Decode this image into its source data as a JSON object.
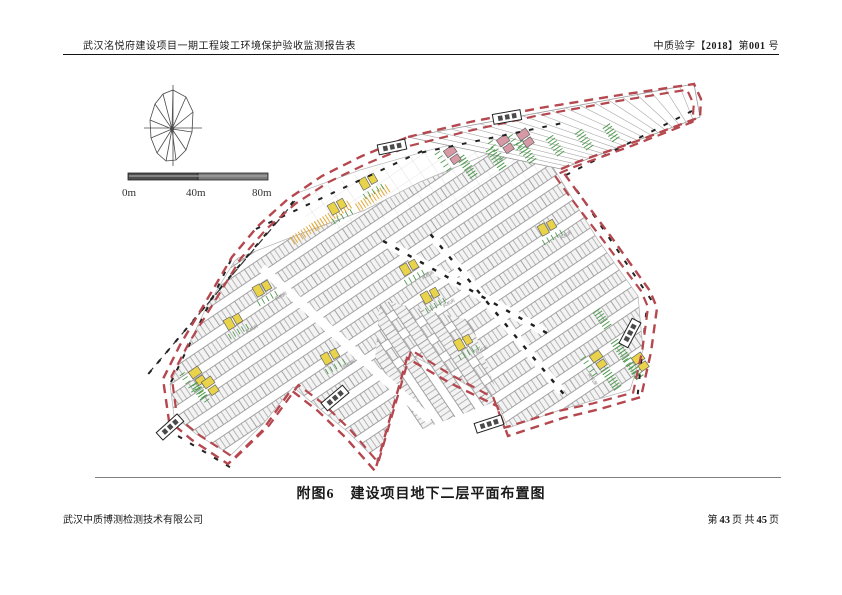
{
  "header": {
    "left": "武汉洺悦府建设项目一期工程竣工环境保护验收监测报告表",
    "right_prefix": "中质验字【",
    "right_year": "2018",
    "right_mid": "】第",
    "right_num": "001",
    "right_suffix": "号"
  },
  "caption": {
    "label": "附图6",
    "title": "建设项目地下二层平面布置图"
  },
  "footer": {
    "company": "武汉中质博测检测技术有限公司",
    "page_prefix": "第",
    "page_current": "43",
    "page_mid": "页 共",
    "page_total": "45",
    "page_suffix": "页"
  },
  "scale_bar": {
    "labels": [
      "0m",
      "40m",
      "80m"
    ]
  },
  "plan": {
    "room_label": "风机房",
    "colors": {
      "boundary": "#b5474f",
      "stall": "#8f8f8f",
      "green": "#4f9b4f",
      "yellow": "#e9d34b",
      "orange": "#e2aa3a",
      "pink": "#d79aa5",
      "black": "#1f1f1f"
    },
    "boundary_outer": [
      [
        408,
        137
      ],
      [
        470,
        122
      ],
      [
        540,
        108
      ],
      [
        620,
        95
      ],
      [
        694,
        84
      ],
      [
        701,
        99
      ],
      [
        700,
        117
      ],
      [
        640,
        140
      ],
      [
        580,
        161
      ],
      [
        561,
        169
      ],
      [
        576,
        190
      ],
      [
        612,
        238
      ],
      [
        650,
        291
      ],
      [
        657,
        308
      ],
      [
        651,
        352
      ],
      [
        641,
        397
      ],
      [
        600,
        409
      ],
      [
        563,
        418
      ],
      [
        508,
        436
      ],
      [
        497,
        406
      ],
      [
        450,
        383
      ],
      [
        407,
        358
      ],
      [
        375,
        471
      ],
      [
        346,
        438
      ],
      [
        318,
        411
      ],
      [
        291,
        390
      ],
      [
        262,
        431
      ],
      [
        228,
        464
      ],
      [
        192,
        440
      ],
      [
        169,
        421
      ],
      [
        163,
        379
      ],
      [
        180,
        345
      ],
      [
        205,
        303
      ],
      [
        232,
        257
      ],
      [
        258,
        226
      ],
      [
        288,
        199
      ],
      [
        322,
        176
      ],
      [
        362,
        156
      ]
    ],
    "grid_band": [
      [
        300,
        195
      ],
      [
        420,
        152
      ],
      [
        560,
        122
      ],
      [
        565,
        168
      ],
      [
        430,
        210
      ],
      [
        310,
        235
      ]
    ],
    "texture_main": [
      [
        238,
        258
      ],
      [
        305,
        232
      ],
      [
        365,
        210
      ],
      [
        420,
        182
      ],
      [
        478,
        158
      ],
      [
        532,
        134
      ],
      [
        556,
        172
      ],
      [
        598,
        240
      ],
      [
        638,
        296
      ],
      [
        643,
        350
      ],
      [
        630,
        390
      ],
      [
        560,
        410
      ],
      [
        508,
        428
      ],
      [
        498,
        404
      ],
      [
        452,
        376
      ],
      [
        409,
        354
      ],
      [
        378,
        462
      ],
      [
        348,
        432
      ],
      [
        293,
        387
      ],
      [
        263,
        424
      ],
      [
        231,
        455
      ],
      [
        196,
        434
      ],
      [
        174,
        416
      ],
      [
        170,
        384
      ],
      [
        206,
        308
      ],
      [
        234,
        262
      ]
    ],
    "texture_alt": [
      [
        380,
        300
      ],
      [
        470,
        320
      ],
      [
        500,
        400
      ],
      [
        420,
        430
      ],
      [
        375,
        360
      ]
    ],
    "strip": {
      "top": [
        [
          408,
          137
        ],
        [
          694,
          84
        ]
      ],
      "bottom": [
        [
          561,
          169
        ],
        [
          700,
          117
        ]
      ],
      "n": 20
    },
    "outline_curve": [
      [
        300,
        192
      ],
      [
        360,
        170
      ],
      [
        430,
        150
      ],
      [
        500,
        133
      ],
      [
        558,
        120
      ]
    ],
    "aisles": [
      {
        "a": [
          432,
          236
        ],
        "b": [
          562,
          392
        ]
      },
      {
        "a": [
          385,
          242
        ],
        "b": [
          545,
          332
        ]
      },
      {
        "a": [
          262,
          268
        ],
        "b": [
          430,
          420
        ]
      }
    ],
    "road_line": {
      "a": [
        148,
        374
      ],
      "b": [
        295,
        201
      ]
    },
    "tick_segments": [
      {
        "a": [
          150,
          372
        ],
        "b": [
          292,
          203
        ]
      },
      {
        "a": [
          258,
          228
        ],
        "b": [
          420,
          152
        ]
      },
      {
        "a": [
          568,
          174
        ],
        "b": [
          690,
          112
        ]
      },
      {
        "a": [
          578,
          192
        ],
        "b": [
          650,
          298
        ]
      },
      {
        "a": [
          646,
          315
        ],
        "b": [
          638,
          392
        ]
      },
      {
        "a": [
          172,
          380
        ],
        "b": [
          230,
          262
        ]
      },
      {
        "a": [
          424,
          152
        ],
        "b": [
          558,
          124
        ]
      },
      {
        "a": [
          168,
          430
        ],
        "b": [
          228,
          466
        ]
      }
    ],
    "green_clusters": [
      [
        468,
        168,
        55,
        8
      ],
      [
        497,
        160,
        55,
        8
      ],
      [
        527,
        153,
        55,
        8
      ],
      [
        556,
        147,
        55,
        7
      ],
      [
        585,
        141,
        55,
        7
      ],
      [
        612,
        134,
        55,
        6
      ],
      [
        603,
        320,
        55,
        7
      ],
      [
        622,
        352,
        55,
        8
      ],
      [
        612,
        380,
        55,
        8
      ],
      [
        636,
        372,
        55,
        6
      ],
      [
        200,
        392,
        55,
        6
      ]
    ],
    "orange_clusters": [
      [
        333,
        215,
        -33,
        14
      ],
      [
        374,
        197,
        -33,
        12
      ],
      [
        306,
        232,
        -33,
        10
      ]
    ],
    "rooms": [
      [
        337,
        207,
        -30,
        "y",
        0
      ],
      [
        368,
        182,
        -30,
        "y",
        0
      ],
      [
        452,
        155,
        55,
        "p",
        0
      ],
      [
        505,
        144,
        55,
        "p",
        0
      ],
      [
        525,
        138,
        55,
        "p",
        0
      ],
      [
        547,
        228,
        -30,
        "y",
        1
      ],
      [
        409,
        268,
        -30,
        "y",
        1
      ],
      [
        430,
        296,
        -30,
        "y",
        1
      ],
      [
        262,
        289,
        -30,
        "y",
        1
      ],
      [
        233,
        322,
        -30,
        "y",
        1
      ],
      [
        197,
        376,
        55,
        "y",
        0
      ],
      [
        210,
        386,
        55,
        "y",
        0
      ],
      [
        330,
        357,
        -30,
        "y",
        1
      ],
      [
        463,
        343,
        -30,
        "y",
        1
      ],
      [
        598,
        360,
        55,
        "y",
        1
      ],
      [
        640,
        362,
        55,
        "y",
        0
      ]
    ],
    "entrances": [
      [
        392,
        147,
        -12
      ],
      [
        507,
        117,
        -10
      ],
      [
        335,
        398,
        -40
      ],
      [
        630,
        333,
        -62
      ],
      [
        489,
        424,
        -18
      ],
      [
        170,
        427,
        -42
      ]
    ]
  }
}
